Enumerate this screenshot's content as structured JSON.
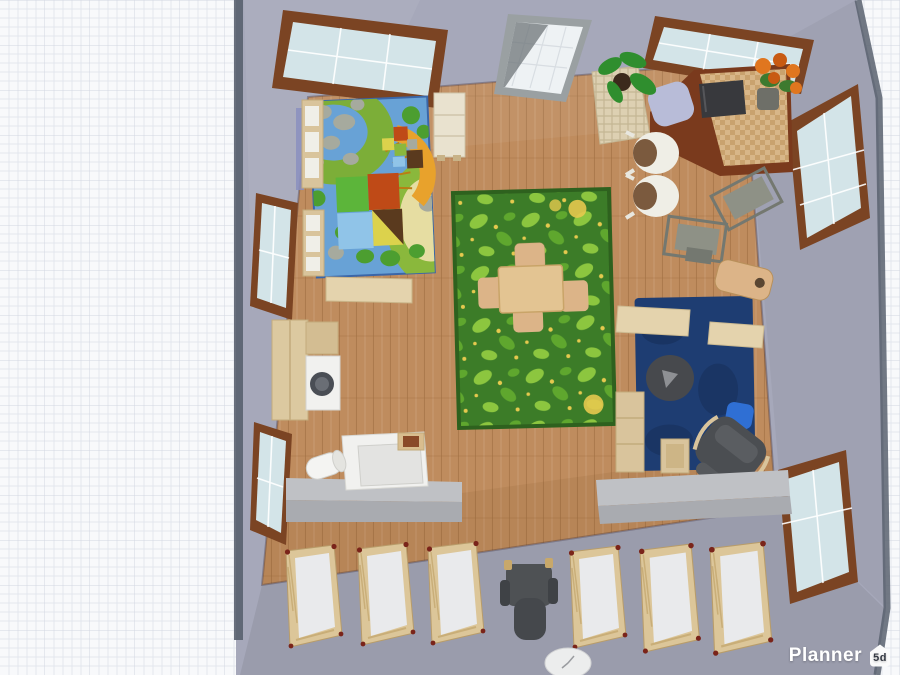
{
  "branding": {
    "app_name": "Planner",
    "badge": "5d"
  },
  "view": {
    "type": "3d-top-down-room-render",
    "description": "Planner 5D viewport: top-down 3D view of a daycare / kids room on a grid canvas"
  },
  "scene": {
    "objects": [
      "play-mat-rug",
      "leaf-rug",
      "navy-rug",
      "kids-table",
      "kids-chairs",
      "crib",
      "crib",
      "crib",
      "crib",
      "crib",
      "crib",
      "high-chair",
      "wall-counter-left",
      "wall-counter-right",
      "changing-unit",
      "washing-machine",
      "tall-cabinet",
      "cubby-shelf",
      "white-cabinet",
      "bench",
      "corner-desk",
      "tv",
      "wicker-basket",
      "potted-plant",
      "flower-pot",
      "white-chair",
      "white-chair",
      "gray-school-desk",
      "gray-school-desk",
      "wood-chair",
      "periwinkle-chair",
      "bean-bag",
      "blue-pillow",
      "rocking-armchair",
      "side-stool",
      "mirror-panel",
      "wall-clock",
      "window-top-left",
      "window-top-right",
      "window-left-upper",
      "window-left-lower",
      "window-right-upper",
      "window-right-lower",
      "wall-poster"
    ]
  },
  "colors": {
    "canvas_bg": "#f8f9fb",
    "grid_minor": "#e3e6ee",
    "grid_major": "#d2d6e2",
    "wall": "#a6a8ba",
    "wall_edge": "#59616f",
    "floor": "#bf8c5e",
    "plank": "#9c6b3f",
    "playmat_base": "#68a2d6",
    "playmat_green": "#7cae38",
    "playmat_green_dark": "#4c9e30",
    "playmat_sand": "#e6dda2",
    "playmat_stone": "#a6aa9e",
    "playmat_ring": "#8ab83c",
    "block_green": "#5cb53a",
    "block_red": "#bf4a17",
    "block_blue": "#90c4e8",
    "block_yellow": "#dcd24c",
    "block_brown": "#5a3a1e",
    "climber_orange": "#e8a22c",
    "climber_stripe": "#b97d14",
    "leafrug_base": "#3c7c28",
    "leafrug_border": "#2e611e",
    "leaf_light": "#8cc63f",
    "leaf_dark": "#5fa72e",
    "leaf_dot": "#e5c94e",
    "navy_rug": "#1e3d72",
    "navy_rug_dark": "#17315c",
    "crib_wood": "#dcc699",
    "crib_mattress": "#e9eaec",
    "crib_knob": "#7a241a",
    "counter": "#bfc1c5",
    "counter_front": "#a9abb0",
    "appliance": "#f1f1ef",
    "appliance_panel": "#e3e3e1",
    "washer_door": "#4a4e55",
    "cabinet_tan": "#dcc9a0",
    "shelf_tan": "#d9c49c",
    "shelf_white": "#f0efe8",
    "bench_tan": "#e4d3ad",
    "table_tan": "#e3c492",
    "chair_tan": "#dcb488",
    "desk_brown": "#7a3a1d",
    "desk_top": "#d8b688",
    "desk_weave": "#c9a26e",
    "tv": "#38393d",
    "chair_white": "#efeee6",
    "chair_cushion": "#7b5a3e",
    "desk_gray": "#8e9186",
    "desk_gray_dark": "#747870",
    "armchair": "#4b4e52",
    "beanbag": "#47494d",
    "beanbag_light": "#8e9094",
    "pillow": "#2f6fd4",
    "highchair": "#4e5154",
    "plant_green": "#2f8e2e",
    "plant_pot": "#3c2a1c",
    "flower_orange": "#e0761f",
    "flower_deep": "#c85a12",
    "foliage": "#3d7a2f",
    "pot_gray": "#6e6f68",
    "chair_periwinkle": "#b8bcd8",
    "window_frame": "#7b4423",
    "window_glass": "#d3e4e8",
    "mirror_frame": "#9aa0a2",
    "mirror_glass": "#eef2f4",
    "basket": "#ddd0b2",
    "basket_line": "#c4b694",
    "clock_face": "#eceded",
    "poster_blue": "#8a8fc0",
    "logo_text": "#ffffff",
    "logo_badge_bg": "#fafafa",
    "logo_badge_text": "#343842"
  }
}
